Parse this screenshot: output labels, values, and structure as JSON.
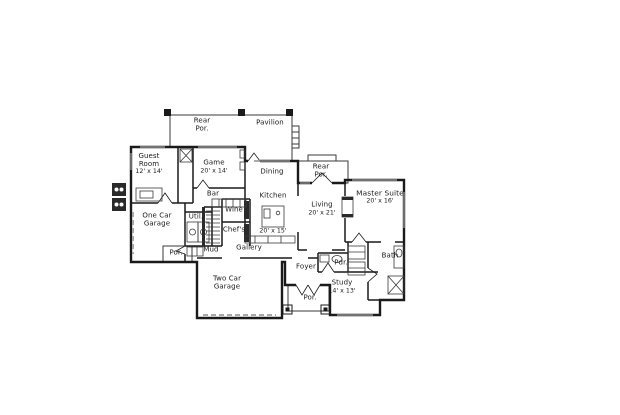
{
  "colors": {
    "wall": "#1a1a1a",
    "window": "#8f8f8f",
    "garage_door": "#a9a9a9",
    "background": "#ffffff",
    "text": "#1a1a1a"
  },
  "rooms": {
    "rear_porch_top": {
      "name_line1": "Rear",
      "name_line2": "Por."
    },
    "pavilion": {
      "name": "Pavilion"
    },
    "guest_room": {
      "name_line1": "Guest",
      "name_line2": "Room",
      "dim": "12' x 14'"
    },
    "game": {
      "name": "Game",
      "dim": "20' x 14'"
    },
    "dining": {
      "name": "Dining"
    },
    "rear_porch_right": {
      "name_line1": "Rear",
      "name_line2": "Por."
    },
    "master_suite": {
      "name": "Master Suite",
      "dim": "20' x 16'"
    },
    "kitchen": {
      "name": "Kitchen",
      "dim": "20' x 15'"
    },
    "living": {
      "name": "Living",
      "dim": "20' x 21'"
    },
    "bar": {
      "name": "Bar"
    },
    "one_car_garage": {
      "name_line1": "One Car",
      "name_line2": "Garage"
    },
    "utility": {
      "name": "Util."
    },
    "wine": {
      "name": "Wine"
    },
    "chefs": {
      "name": "Chef's"
    },
    "mud": {
      "name": "Mud"
    },
    "gallery": {
      "name": "Gallery"
    },
    "porch_left": {
      "name": "Por."
    },
    "two_car_garage": {
      "name_line1": "Two Car",
      "name_line2": "Garage"
    },
    "foyer": {
      "name": "Foyer"
    },
    "powder": {
      "name": "Pdr."
    },
    "study": {
      "name": "Study",
      "dim": "14' x 13'"
    },
    "porch_front": {
      "name": "Por."
    },
    "bath": {
      "name": "Bath"
    }
  }
}
